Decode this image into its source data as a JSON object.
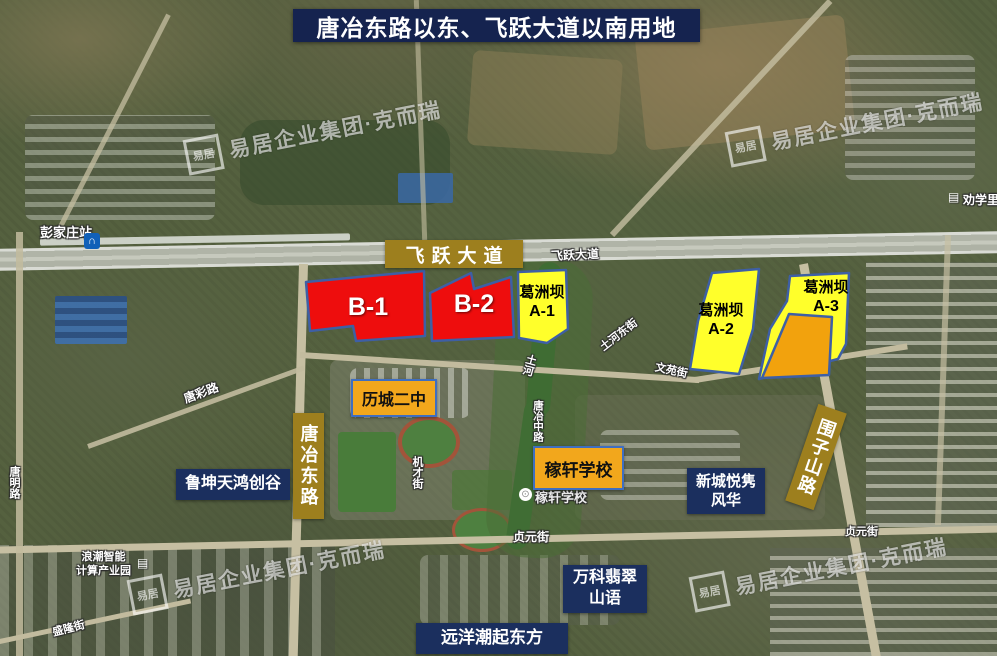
{
  "title": "唐冶东路以东、飞跃大道以南用地",
  "watermark": {
    "seal": "易居",
    "text": "易居企业集团·克而瑞"
  },
  "colors": {
    "title_bg": "#15234f",
    "navy_box_bg": "#1b2f5e",
    "gold_label_bg": "#9d7f1e",
    "amber_box_bg": "#f2a71c",
    "amber_box_border": "#3f6ec0",
    "parcel_border": "#3e5fa5",
    "parcel_red": "#ee0d0d",
    "parcel_yellow": "#ffff2b",
    "parcel_orange": "#f2a20d"
  },
  "road_labels": {
    "feiyue": "飞跃大道",
    "tangye_east": "唐冶东路",
    "weizishan": "围子山路"
  },
  "parcels": {
    "b1": {
      "code": "B-1"
    },
    "b2": {
      "code": "B-2"
    },
    "a1": {
      "name": "葛洲坝",
      "code": "A-1"
    },
    "a2": {
      "name": "葛洲坝",
      "code": "A-2"
    },
    "a3": {
      "name": "葛洲坝",
      "code": "A-3"
    }
  },
  "poi_boxes": {
    "licheng_no2": "历城二中",
    "jiaxuan_school": "稼轩学校",
    "lukun": "鲁坤天鸿创谷",
    "xincheng_line1": "新城悦隽",
    "xincheng_line2": "风华",
    "vanke_line1": "万科翡翠",
    "vanke_line2": "山语",
    "yuanyang": "远洋潮起东方"
  },
  "map_labels": {
    "pengjiazhuang_station": "彭家庄站",
    "feiyue_road_small": "飞跃大道",
    "tangcai_road": "唐彩路",
    "tangming_road": "唐明路",
    "tuhe_east_street": "土河东街",
    "wenyuan_street": "文苑街",
    "tuhe_river": "土河",
    "tangye_middle_road": "唐冶中路",
    "jicai_street": "机才街",
    "jiaxuan_small": "稼轩学校",
    "zhenyuan_street": "贞元街",
    "shenglong_street": "盛隆街",
    "langchao_line1": "浪潮智能",
    "langchao_line2": "计算产业园",
    "quanxueli": "劝学里"
  },
  "icons": {
    "metro_glyph": "∩",
    "building_glyph": "▤",
    "school_poi_glyph": "⊙"
  }
}
